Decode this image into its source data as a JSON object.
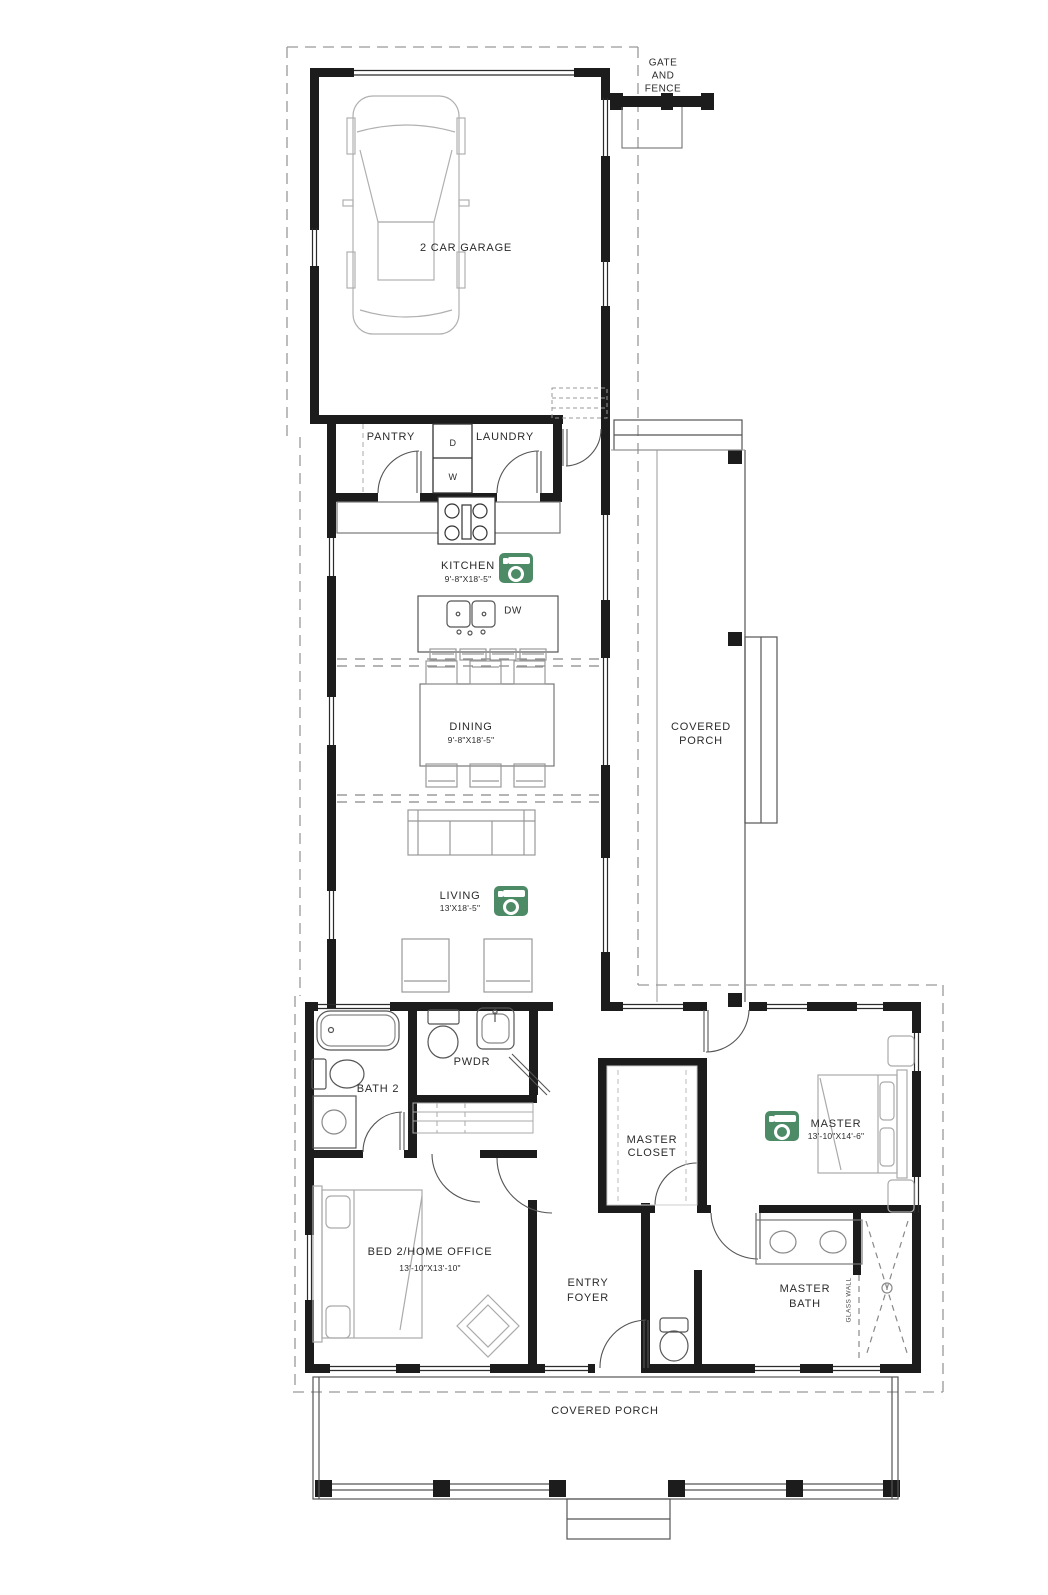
{
  "colors": {
    "wall": "#1c1c1c",
    "fixture_line": "#555555",
    "furniture_line": "#aaaaaa",
    "dash_line": "#999999",
    "camera_green": "#4d8a66",
    "background": "#ffffff",
    "label_text": "#2b2b2b"
  },
  "site": {
    "gate_fence": {
      "line1": "GATE",
      "line2": "AND",
      "line3": "FENCE"
    }
  },
  "rooms": {
    "garage": {
      "label": "2 CAR GARAGE"
    },
    "pantry": {
      "label": "PANTRY"
    },
    "laundry": {
      "label": "LAUNDRY",
      "dryer": "D",
      "washer": "W"
    },
    "kitchen": {
      "label": "KITCHEN",
      "dims": "9'-8\"X18'-5\"",
      "dishwasher": "DW"
    },
    "dining": {
      "label": "DINING",
      "dims": "9'-8\"X18'-5\""
    },
    "covered_porch_side": {
      "line1": "COVERED",
      "line2": "PORCH"
    },
    "living": {
      "label": "LIVING",
      "dims": "13'X18'-5\""
    },
    "bath2": {
      "label": "BATH 2"
    },
    "powder": {
      "label": "PWDR"
    },
    "master_closet": {
      "line1": "MASTER",
      "line2": "CLOSET"
    },
    "master": {
      "label": "MASTER",
      "dims": "13'-10\"X14'-6\""
    },
    "bed2": {
      "label": "BED 2/HOME OFFICE",
      "dims": "13'-10\"X13'-10\""
    },
    "entry_foyer": {
      "line1": "ENTRY",
      "line2": "FOYER"
    },
    "master_bath": {
      "line1": "MASTER",
      "line2": "BATH",
      "glass_wall": "GLASS WALL"
    },
    "covered_porch_front": {
      "label": "COVERED PORCH"
    }
  },
  "icons": {
    "camera": "photo-camera-icon"
  }
}
